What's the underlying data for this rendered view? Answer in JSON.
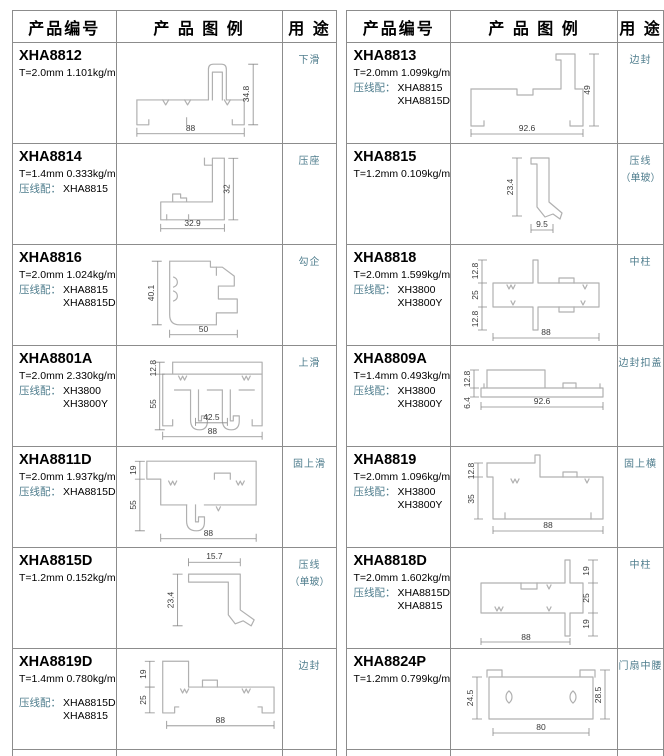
{
  "header": {
    "code": "产品编号",
    "figure": "产 品 图 例",
    "use": "用 途"
  },
  "colors": {
    "accent_teal": "#4f7d8d",
    "border_gray": "#8c8c8c",
    "profile_gray": "#b0b0b0"
  },
  "tables": [
    {
      "rows": [
        {
          "code": "XHA8812",
          "spec": "T=2.0mm  1.101kg/m",
          "match_label": "",
          "match1": "",
          "match2": "",
          "use": "下滑",
          "use2": "",
          "dims": {
            "w": "88",
            "h": "34.8"
          }
        },
        {
          "code": "XHA8814",
          "spec": "T=1.4mm  0.333kg/m",
          "match_label": "压线配：",
          "match1": "XHA8815",
          "match2": "",
          "use": "压座",
          "use2": "",
          "dims": {
            "w": "32.9",
            "h": "32"
          }
        },
        {
          "code": "XHA8816",
          "spec": "T=2.0mm  1.024kg/m",
          "match_label": "压线配：",
          "match1": "XHA8815",
          "match2": "XHA8815D",
          "use": "勾企",
          "use2": "",
          "dims": {
            "w": "50",
            "h": "40.1"
          }
        },
        {
          "code": "XHA8801A",
          "spec": "T=2.0mm  2.330kg/m",
          "match_label": "压线配：",
          "match1": "XH3800",
          "match2": "XH3800Y",
          "use": "上滑",
          "use2": "",
          "dims": {
            "d1": "12.8",
            "d2": "55",
            "d3": "42.5",
            "w": "88"
          }
        },
        {
          "code": "XHA8811D",
          "spec": "T=2.0mm  1.937kg/m",
          "match_label": "压线配：",
          "match1": "XHA8815D",
          "match2": "",
          "use": "固上滑",
          "use2": "",
          "dims": {
            "d1": "19",
            "d2": "55",
            "w": "88"
          }
        },
        {
          "code": "XHA8815D",
          "spec": "T=1.2mm  0.152kg/m",
          "match_label": "",
          "match1": "",
          "match2": "",
          "use": "压线",
          "use2": "（单玻）",
          "dims": {
            "d1": "15.7",
            "d2": "23.4"
          }
        },
        {
          "code": "XHA8819D",
          "spec": "T=1.4mm  0.780kg/m",
          "match_label": "压线配：",
          "match1": "XHA8815D",
          "match2": "XHA8815",
          "use": "边封",
          "use2": "",
          "dims": {
            "d1": "19",
            "d2": "25",
            "w": "88"
          }
        }
      ]
    },
    {
      "rows": [
        {
          "code": "XHA8813",
          "spec": "T=2.0mm  1.099kg/m",
          "match_label": "压线配：",
          "match1": "XHA8815",
          "match2": "XHA8815D",
          "use": "边封",
          "use2": "",
          "dims": {
            "w": "92.6",
            "h": "49"
          }
        },
        {
          "code": "XHA8815",
          "spec": "T=1.2mm  0.109kg/m",
          "match_label": "",
          "match1": "",
          "match2": "",
          "use": "压线",
          "use2": "（单玻）",
          "dims": {
            "d1": "23.4",
            "d2": "9.5"
          }
        },
        {
          "code": "XHA8818",
          "spec": "T=2.0mm  1.599kg/m",
          "match_label": "压线配：",
          "match1": "XH3800",
          "match2": "XH3800Y",
          "use": "中柱",
          "use2": "",
          "dims": {
            "d1": "12.8",
            "d2": "25",
            "d3": "12.8",
            "w": "88"
          }
        },
        {
          "code": "XHA8809A",
          "spec": "T=1.4mm  0.493kg/m",
          "match_label": "压线配：",
          "match1": "XH3800",
          "match2": "XH3800Y",
          "use": "边封扣盖",
          "use2": "",
          "dims": {
            "d1": "12.8",
            "d2": "6.4",
            "w": "92.6"
          }
        },
        {
          "code": "XHA8819",
          "spec": "T=2.0mm  1.096kg/m",
          "match_label": "压线配：",
          "match1": "XH3800",
          "match2": "XH3800Y",
          "use": "固上横",
          "use2": "",
          "dims": {
            "d1": "12.8",
            "d2": "35",
            "w": "88"
          }
        },
        {
          "code": "XHA8818D",
          "spec": "T=2.0mm  1.602kg/m",
          "match_label": "压线配：",
          "match1": "XHA8815D",
          "match2": "XHA8815",
          "use": "中柱",
          "use2": "",
          "dims": {
            "d1": "19",
            "d2": "25",
            "d3": "19",
            "w": "88"
          }
        },
        {
          "code": "XHA8824P",
          "spec": "T=1.2mm  0.799kg/m",
          "match_label": "",
          "match1": "",
          "match2": "",
          "use": "门扇中腰",
          "use2": "",
          "dims": {
            "d1": "24.5",
            "d2": "28.5",
            "w": "80"
          }
        }
      ]
    }
  ]
}
